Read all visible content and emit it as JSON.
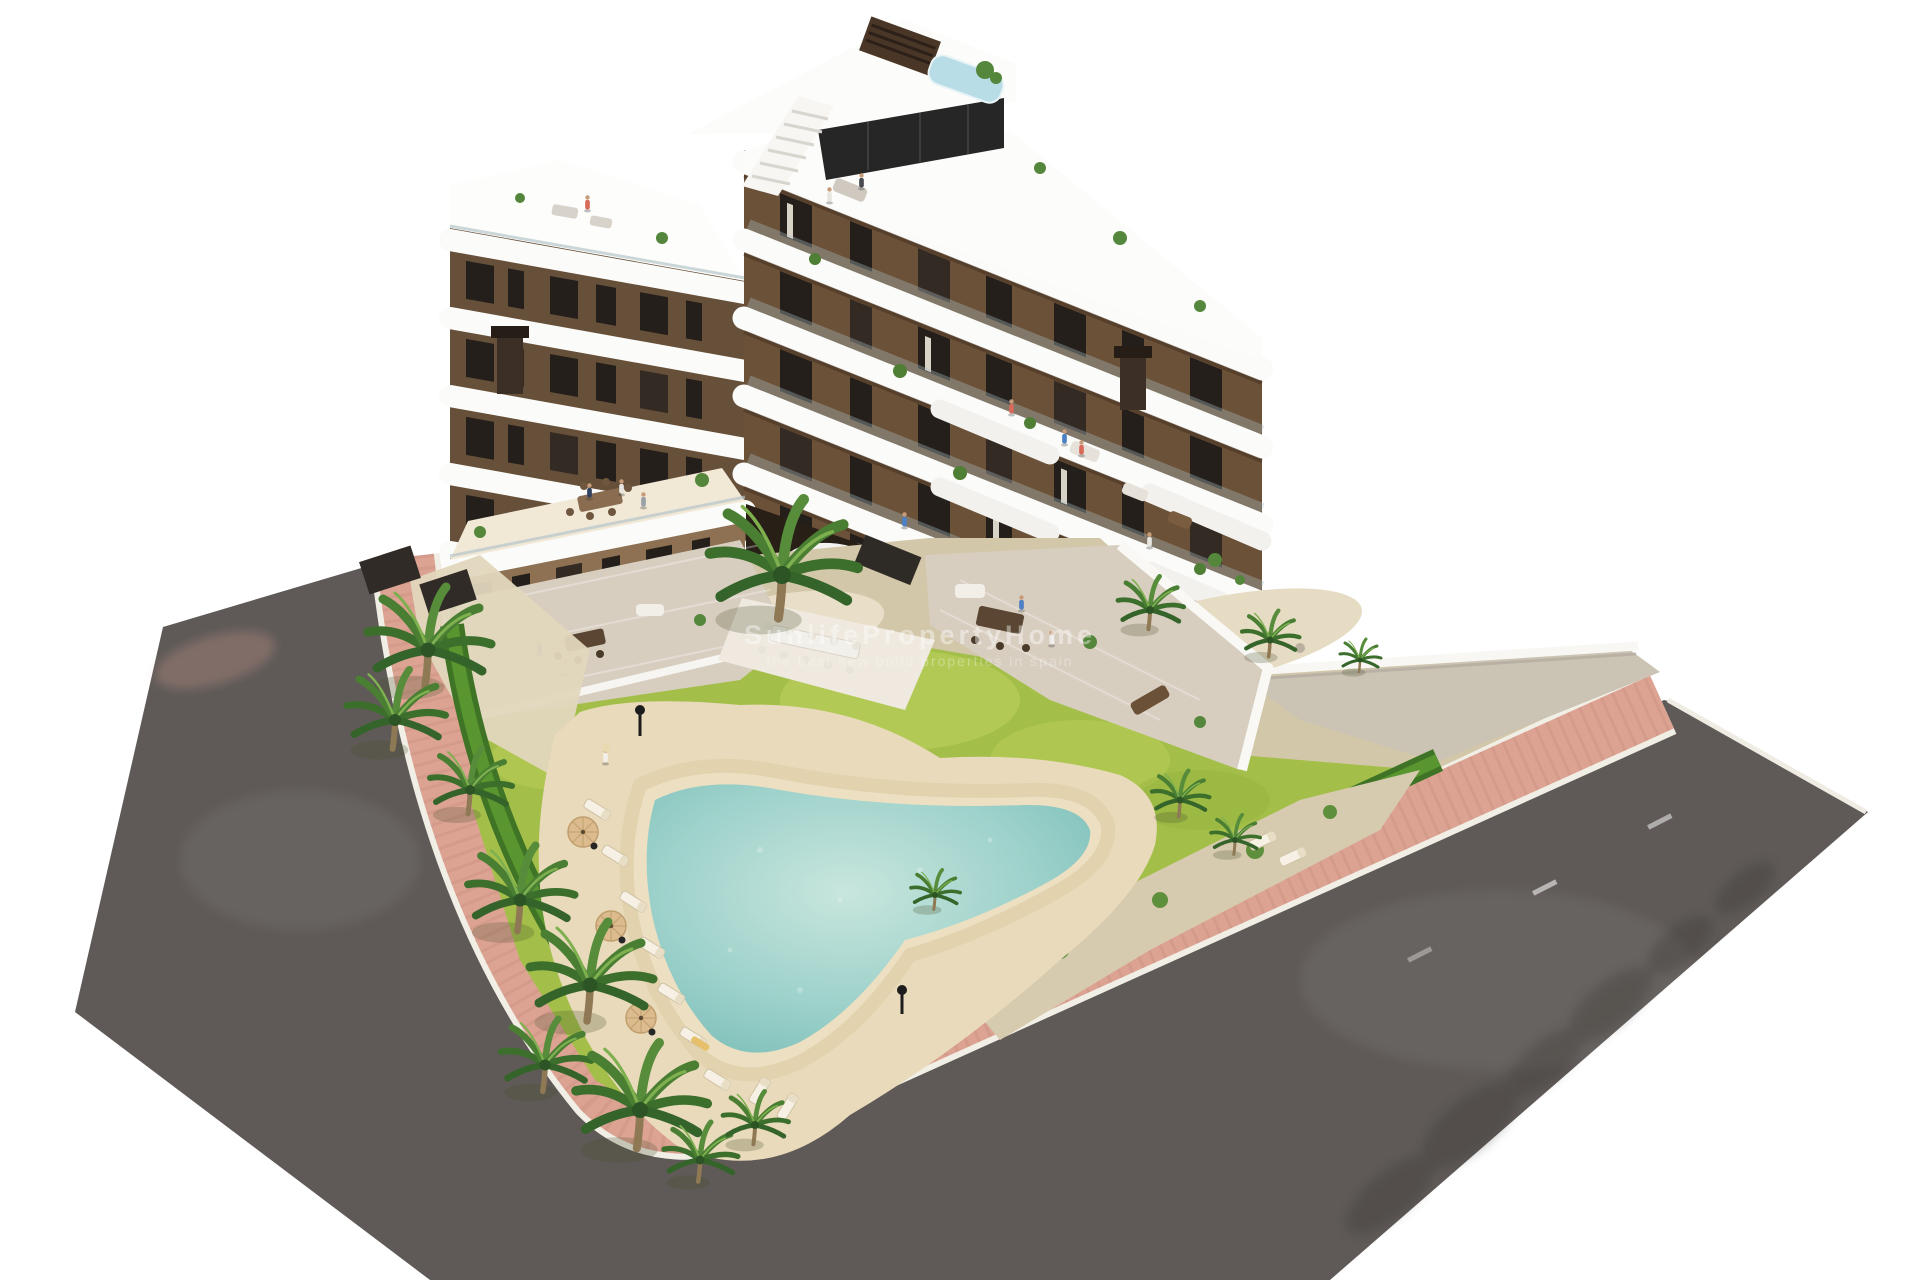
{
  "scene": {
    "type": "architectural-3d-aerial-render",
    "subject": "Modern multi-storey apartment building on a corner plot with rooftop terraces, communal garden, free-form swimming pool, pink paver sidewalk, asphalt streets and one white car",
    "background": "#ffffff",
    "watermark": {
      "line1": "SunlifePropertyHome",
      "line2": "the best new build properties in spain"
    },
    "building": {
      "visible_floor_bands": 7,
      "facade_style": "brown render walls with curved white balcony slabs and glass balustrades",
      "rooftop_features": [
        "staircase",
        "louvered-chimneys",
        "penthouse-glass",
        "plunge-pool",
        "planters",
        "lounge-furniture"
      ],
      "chimney_count": 3
    },
    "garden": {
      "features": [
        "free-form-pool",
        "sun-loungers",
        "tan-parasols",
        "palm-trees",
        "lawn",
        "gravel-islands",
        "hedge-border",
        "communal-dining-terrace"
      ],
      "parasol_count": 3
    },
    "street": {
      "car_count": 1,
      "car_color": "white",
      "road_surface": "dark asphalt",
      "sidewalk": "pink brick pavers with white curbs",
      "lane_marking": "short dashed white line"
    }
  },
  "palette": {
    "facade_brown": "#6b5138",
    "facade_left": "#67503a",
    "facade_light": "#8d7152",
    "band_white": "#fbfbf9",
    "window_glass": "#241f1b",
    "lawn_green": "#a3bf49",
    "hedge_green": "#3f7427",
    "hedge_light": "#5c9a31",
    "pool_water": "#8fc9c4",
    "pool_sand": "#ecdfc2",
    "deck_cream": "#e9dabb",
    "sidewalk_pink": "#dca393",
    "curb_white": "#f1eee6",
    "road_asphalt": "#5f5a57",
    "pavement_beige": "#cbc3b3",
    "terrace_tile": "#d8cec0",
    "garden_base": "#d3c7a9",
    "car_white": "#f7f7f5",
    "car_glass": "#2f3437",
    "taillight_red": "#c03425",
    "chimney_brown": "#4a3626",
    "rooftop_pool_blue": "#b9dde7"
  }
}
